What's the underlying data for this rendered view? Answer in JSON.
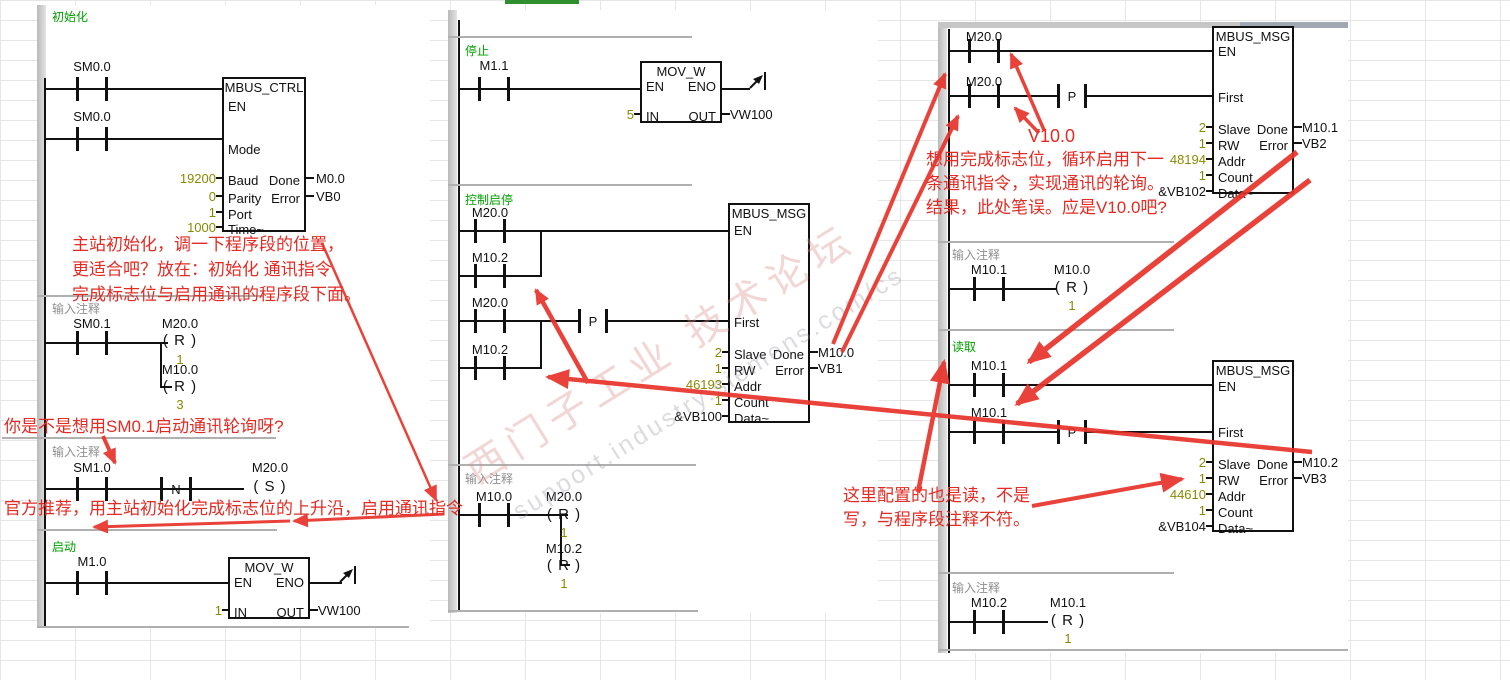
{
  "colors": {
    "accent_red": "#e32b24",
    "title_green": "#00a000",
    "comment_gray": "#8f8f8f",
    "value_olive": "#8a8a00",
    "selected_cell_green": "#2f8f2f"
  },
  "watermark": {
    "line1": "西门子工业 技术论坛",
    "line2": "support.industry.siemens.com/cs"
  },
  "left": {
    "n1": {
      "title": "初始化",
      "c1": "SM0.0",
      "c2": "SM0.0",
      "box": {
        "title": "MBUS_CTRL",
        "en": "EN",
        "mode": "Mode",
        "baud": "Baud",
        "parity": "Parity",
        "port": "Port",
        "time": "Time~",
        "done": "Done",
        "error": "Error",
        "baud_val": "19200",
        "parity_val": "0",
        "port_val": "1",
        "time_val": "1000",
        "done_out": "M0.0",
        "error_out": "VB0"
      }
    },
    "note1_l1": "主站初始化，调一下程序段的位置，",
    "note1_l2": "更适合吧？放在：初始化 通讯指令",
    "note1_l3": "完成标志位与启用通讯的程序段下面。",
    "n2": {
      "title": "输入注释",
      "c1": "SM0.1",
      "coil1_label": "M20.0",
      "coil1": "( R )",
      "coil1_val": "1",
      "coil2_label": "M10.0",
      "coil2": "( R )",
      "coil2_val": "3"
    },
    "note2": "你是不是想用SM0.1启动通讯轮询呀?",
    "n3": {
      "title": "输入注释",
      "c1": "SM1.0",
      "nbox": "N",
      "coil_label": "M20.0",
      "coil": "( S )"
    },
    "note3": "官方推荐，用主站初始化完成标志位的上升沿，启用通讯指令",
    "n4": {
      "title": "启动",
      "c1": "M1.0",
      "box": {
        "title": "MOV_W",
        "en": "EN",
        "eno": "ENO",
        "in": "IN",
        "out": "OUT",
        "in_val": "1",
        "out_val": "VW100"
      }
    }
  },
  "middle": {
    "n5": {
      "title": "停止",
      "c1": "M1.1",
      "box": {
        "title": "MOV_W",
        "en": "EN",
        "eno": "ENO",
        "in": "IN",
        "out": "OUT",
        "in_val": "5",
        "out_val": "VW100"
      }
    },
    "n6": {
      "title": "控制启停",
      "c1": "M20.0",
      "c2": "M10.2",
      "c3": "M20.0",
      "c4": "M10.2",
      "pbox": "P",
      "box": {
        "title": "MBUS_MSG",
        "en": "EN",
        "first": "First",
        "slave": "Slave",
        "rw": "RW",
        "addr": "Addr",
        "count": "Count",
        "data": "Data~",
        "done": "Done",
        "error": "Error",
        "slave_val": "2",
        "rw_val": "1",
        "addr_val": "46193",
        "count_val": "1",
        "data_val": "&VB100",
        "done_out": "M10.0",
        "error_out": "VB1"
      }
    },
    "n7": {
      "title": "输入注释",
      "c1": "M10.0",
      "coil1_label": "M20.0",
      "coil1": "( R )",
      "coil1_val": "1",
      "coil2_label": "M10.2",
      "coil2": "( R )",
      "coil2_val": "1"
    }
  },
  "right": {
    "n8": {
      "c1": "M20.0",
      "c2": "M20.0",
      "pbox": "P",
      "box": {
        "title": "MBUS_MSG",
        "en": "EN",
        "first": "First",
        "slave": "Slave",
        "rw": "RW",
        "addr": "Addr",
        "count": "Count",
        "data": "Data~",
        "done": "Done",
        "error": "Error",
        "slave_val": "2",
        "rw_val": "1",
        "addr_val": "48194",
        "count_val": "1",
        "data_val": "&VB102",
        "done_out": "M10.1",
        "error_out": "VB2"
      }
    },
    "note_v100": "V10.0",
    "note4_l1": "想用完成标志位，循环启用下一",
    "note4_l2": "条通讯指令，实现通讯的轮询。",
    "note4_l3": "结果，此处笔误。应是V10.0吧?",
    "n9": {
      "title": "输入注释",
      "c1": "M10.1",
      "coil_label": "M10.0",
      "coil": "( R )",
      "coil_val": "1"
    },
    "n10": {
      "title": "读取",
      "c1": "M10.1",
      "c2": "M10.1",
      "pbox": "P",
      "box": {
        "title": "MBUS_MSG",
        "en": "EN",
        "first": "First",
        "slave": "Slave",
        "rw": "RW",
        "addr": "Addr",
        "count": "Count",
        "data": "Data~",
        "done": "Done",
        "error": "Error",
        "slave_val": "2",
        "rw_val": "1",
        "addr_val": "44610",
        "count_val": "1",
        "data_val": "&VB104",
        "done_out": "M10.2",
        "error_out": "VB3"
      }
    },
    "note5_l1": "这里配置的也是读，不是",
    "note5_l2": "写，与程序段注释不符。",
    "n11": {
      "title": "输入注释",
      "c1": "M10.2",
      "coil_label": "M10.1",
      "coil": "( R )",
      "coil_val": "1"
    }
  }
}
